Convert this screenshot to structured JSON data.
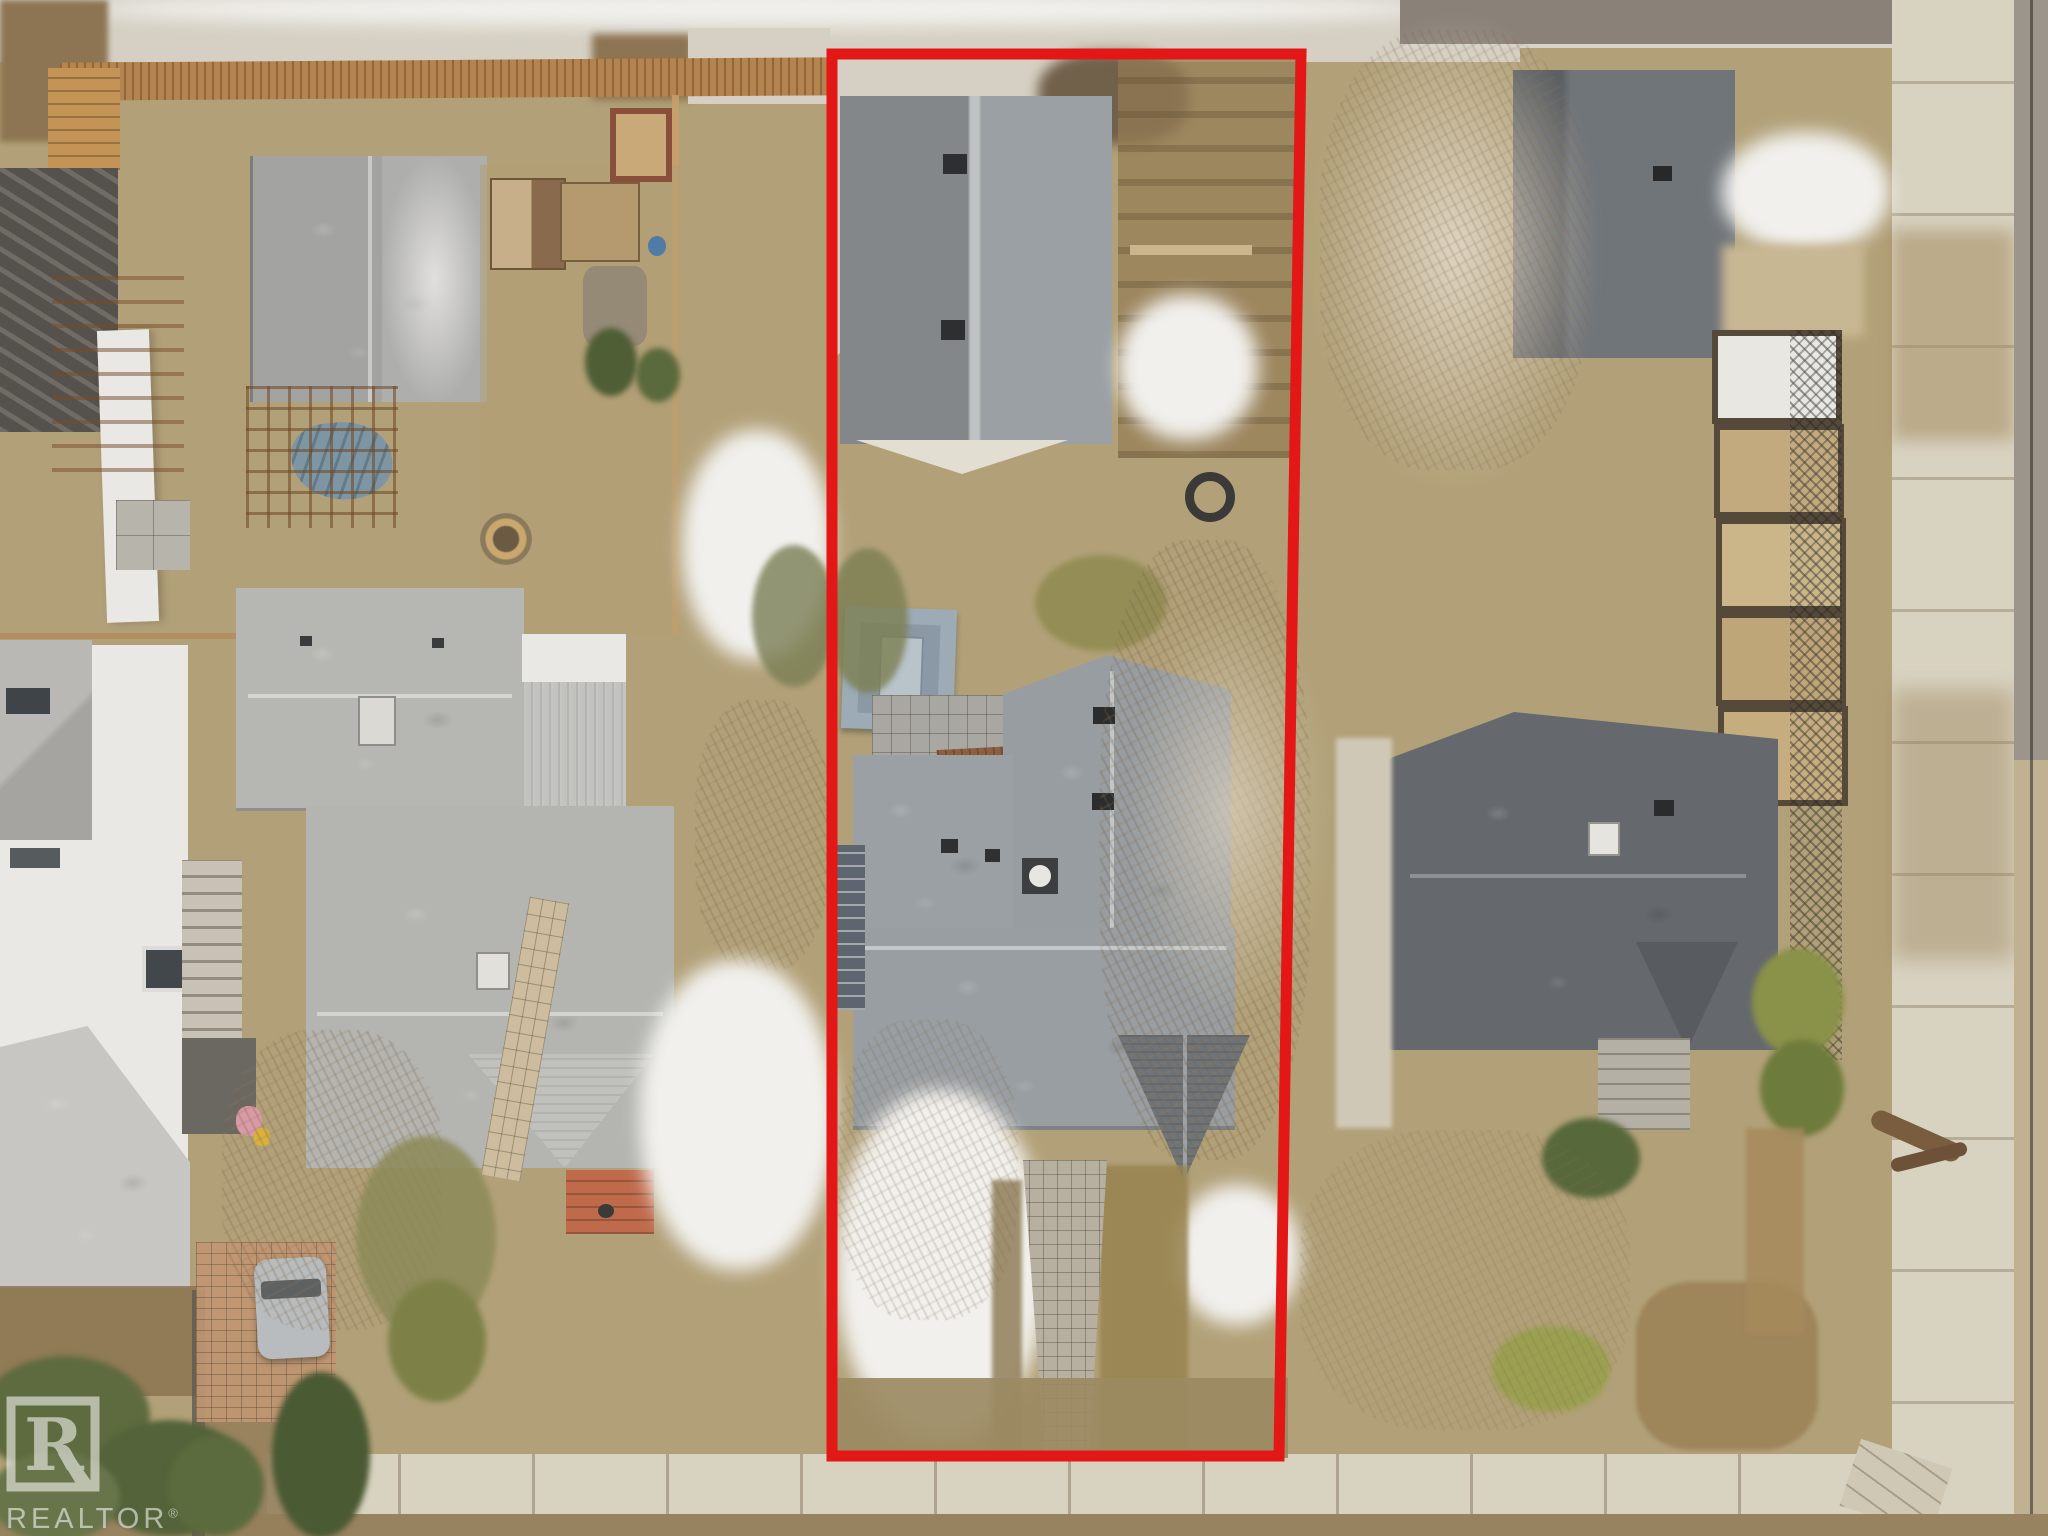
{
  "photo": {
    "type": "aerial-drone-photograph",
    "season": "late-winter, patchy snow on dead grass",
    "subject": "residential lot outlined in red, viewed straight down",
    "description": "Top-down drone photo of a residential block: subject lot outlined in red contains a detached garage at the alley, a small blue-gray hip-roof shed, a large gray-shingled house with front walkway; neighboring lots show gray roofs, wood fences, bare frosted trees, evergreen shrubs, concrete alley at top and sidewalks at bottom and right."
  },
  "watermark": {
    "text": "REALTOR",
    "registered_mark": "®",
    "logo": "realtor-block-r-logo",
    "color": "#ffffff"
  },
  "outline": {
    "shape": "quadrilateral",
    "color": "#e41717",
    "stroke_px": 11,
    "points": "832,54 1301,54 1279,1456 832,1456"
  },
  "palette": {
    "ground": "#b2a178",
    "snow": "#f1f0ed",
    "concrete": "#d5d0c3",
    "sidewalk": "#d8d2c0",
    "asphalt": "#8a8178",
    "roofdark": "#5f6367",
    "roofmid": "#8e9396",
    "rooflight": "#b7b8b4",
    "roofpale": "#c7c6c2",
    "roofblue": "#9cabb6",
    "whitewall": "#e9e8e4",
    "fencewood": "#b5834e",
    "deckwood": "#c49457",
    "brickpath": "#c29772",
    "reddeck": "#c06a4c",
    "greendark": "#4f5e35",
    "greenolive": "#8c8a58",
    "scrub": "#9b8a62",
    "soil": "#8d7452",
    "tarp": "#7e95a3",
    "frost": "#d8cdbb"
  }
}
